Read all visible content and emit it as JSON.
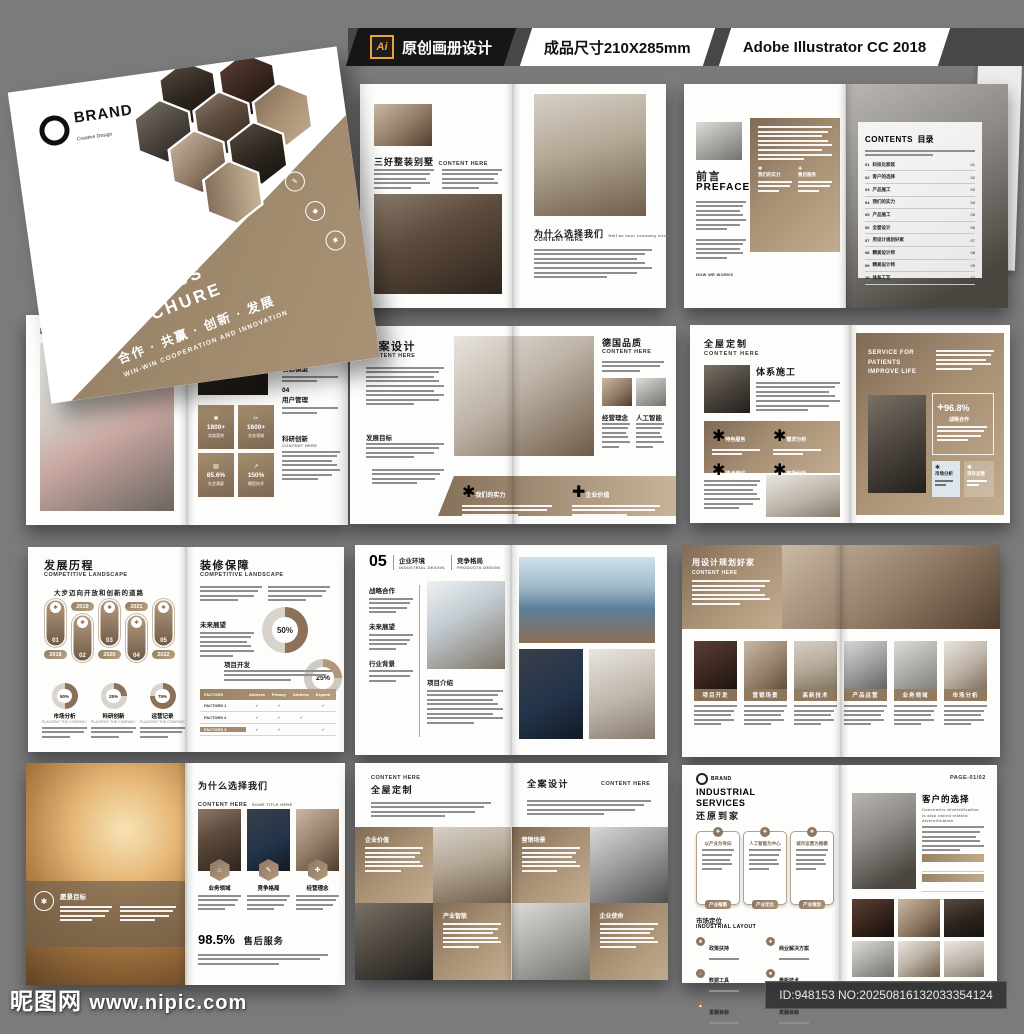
{
  "header": {
    "ai_badge": "Ai",
    "design_label": "原创画册设计",
    "size_label": "成品尺寸210X285mm",
    "software_label": "Adobe Illustrator CC 2018"
  },
  "cover": {
    "brand": "BRAND",
    "brand_sub": "Creative Design",
    "title1": "NEW",
    "title2": "BUSINESS",
    "title3": "BROCHURE",
    "slogan_cn": "合作 · 共赢 · 创新 · 发展",
    "slogan_en": "WIN-WIN COOPERATION AND INNOVATION"
  },
  "spread_a": {
    "left": {
      "title": "三好整装别墅",
      "suffix": "CONTENT HERE"
    },
    "right": {
      "title": "为什么选择我们",
      "subtitle": "CONTENT HERE",
      "note": "Half an hour economy circle"
    }
  },
  "spread_b": {
    "left": {
      "title_cn": "前言",
      "title_en": "PREFACE",
      "col1": "我们的实力",
      "col2": "售后服务",
      "footer": "HOW WE WORKS"
    },
    "right": {
      "title_en": "CONTENTS",
      "title_cn": "目录",
      "items": [
        {
          "no": "01",
          "label": "科技化家装",
          "page": "01"
        },
        {
          "no": "02",
          "label": "客户的选择",
          "page": "02"
        },
        {
          "no": "03",
          "label": "产品施工",
          "page": "03"
        },
        {
          "no": "04",
          "label": "我们的实力",
          "page": "04"
        },
        {
          "no": "05",
          "label": "产品施工",
          "page": "05"
        },
        {
          "no": "06",
          "label": "全屋设计",
          "page": "06"
        },
        {
          "no": "07",
          "label": "用设计规划好家",
          "page": "07"
        },
        {
          "no": "08",
          "label": "精美设计师",
          "page": "08"
        },
        {
          "no": "09",
          "label": "精美设计师",
          "page": "09"
        },
        {
          "no": "10",
          "label": "体系工艺",
          "page": "10"
        }
      ]
    }
  },
  "spread_c": {
    "left": {
      "title": "DEVELOPMENT GOAL"
    },
    "right": {
      "items": [
        {
          "no": "02",
          "label": "服务保障"
        },
        {
          "no": "03",
          "label": "信息模型"
        },
        {
          "no": "04",
          "label": "用户管理"
        }
      ],
      "section": "科研创新",
      "section_sub": "CONTENT HERE",
      "stats": [
        {
          "icon": "✱",
          "value": "1800+",
          "label": "实践案例"
        },
        {
          "icon": "✂",
          "value": "1600+",
          "label": "业务领域"
        },
        {
          "icon": "▤",
          "value": "85.6%",
          "label": "社会满意"
        },
        {
          "icon": "↗",
          "value": "150%",
          "label": "模型技术"
        }
      ]
    }
  },
  "spread_d": {
    "left": {
      "title": "全案设计",
      "subtitle": "CONTENT HERE",
      "section": "发展目标"
    },
    "right": {
      "title": "德国品质",
      "subtitle": "CONTENT HERE",
      "col1": "经营理念",
      "col2": "人工智能"
    },
    "band": {
      "item1": "我们的实力",
      "item2": "企业价值"
    }
  },
  "spread_e": {
    "left": {
      "title": "全屋定制",
      "subtitle": "CONTENT HERE",
      "section": "体系施工",
      "features": [
        "特色服务",
        "需求分析",
        "技术培训",
        "市场分析"
      ]
    },
    "right": {
      "tag1": "SERVICE FOR",
      "tag2": "PATIENTS",
      "tag3": "IMPROVE LIFE",
      "stat_plus": "+",
      "stat_value": "96.8%",
      "stat_label": "战略合作",
      "box1": "市场分析",
      "box2": "项目运营"
    }
  },
  "spread_f": {
    "left": {
      "title": "发展历程",
      "title_en": "COMPETITIVE LANDSCAPE",
      "subtitle": "大步迈向开放和创新的道路",
      "timeline": [
        {
          "no": "01",
          "year": "2018"
        },
        {
          "no": "02",
          "year": "2019"
        },
        {
          "no": "03",
          "year": "2020"
        },
        {
          "no": "04",
          "year": "2021"
        },
        {
          "no": "05",
          "year": "2022"
        }
      ],
      "donuts": [
        {
          "pct": "50%",
          "label": "市场分析",
          "sub": "PLACERAT THE COMPANY."
        },
        {
          "pct": "25%",
          "label": "科研创新",
          "sub": "PLACERAT THE COMPANY."
        },
        {
          "pct": "75%",
          "label": "运营记录",
          "sub": "PLACERAT THE COMPANY."
        }
      ]
    },
    "right": {
      "title": "装修保障",
      "title_en": "COMPETITIVE LANDSCAPE",
      "future": "未来展望",
      "donut1": "50%",
      "donut2": "25%",
      "section": "项目开发",
      "table": {
        "head": [
          "FACTORS",
          "Address",
          "Privacy",
          "Address",
          "Expand"
        ],
        "rows": [
          {
            "label": "FACTORS 1",
            "c": [
              "✓",
              "✓",
              "",
              "✓"
            ]
          },
          {
            "label": "FACTORS 2",
            "c": [
              "✓",
              "✓",
              "✓",
              ""
            ]
          },
          {
            "label": "FACTORS 3",
            "c": [
              "✓",
              "✓",
              "",
              "✓"
            ]
          }
        ]
      }
    }
  },
  "spread_g": {
    "no": "05",
    "col1_cn": "企业环境",
    "col1_en": "INDUSTRIAL DESIGN",
    "col2_cn": "竞争格局",
    "col2_en": "PRODUCTS DESIGN",
    "sections": [
      "战略合作",
      "未来展望",
      "行业背景"
    ],
    "section_bottom": "项目介绍"
  },
  "spread_h": {
    "title": "用设计规划好家",
    "subtitle": "CONTENT HERE",
    "cards": [
      "项目开发",
      "营销场景",
      "高新技术",
      "产品运营",
      "业务领域",
      "市场分析"
    ]
  },
  "spread_i": {
    "left": {
      "overlay": "愿景目标"
    },
    "right": {
      "title": "为什么选择我们",
      "sub1": "CONTENT HERE",
      "sub2": "SOME TITLE HERE",
      "cards": [
        "业务领域",
        "竞争格局",
        "经营理念"
      ],
      "stat": "98.5%",
      "stat_label": "售后服务"
    }
  },
  "spread_j": {
    "left": {
      "eyebrow": "CONTENT HERE",
      "title": "全屋定制",
      "block1": "企业价值",
      "block2": "产业智联"
    },
    "right": {
      "title": "全案设计",
      "eyebrow": "CONTENT HERE",
      "block1": "营销场景",
      "block2": "企业使命"
    }
  },
  "spread_k": {
    "left": {
      "brand": "BRAND",
      "title_en": "INDUSTRIAL SERVICES",
      "title_cn": "还原到家",
      "bubbles": [
        {
          "title": "以产业为导向",
          "tag": "产业楷模"
        },
        {
          "title": "人工智能为中心",
          "tag": "产业定位"
        },
        {
          "title": "城市运营为楷模",
          "tag": "产业规划"
        }
      ],
      "section": "市场定位",
      "section_en": "INDUSTRIAL LAYOUT",
      "bullets": [
        "政策扶持",
        "数据工具",
        "发展目标",
        "商业解决方案",
        "最新技术",
        "发展目标"
      ]
    },
    "right": {
      "page": "PAGE-01/02",
      "title": "客户的选择",
      "subtitle": "Concentric diversification is also called related diversification"
    }
  },
  "watermark": {
    "site": "昵图网",
    "url": "www.nipic.com",
    "id": "ID:948153 NO:20250816132033354124"
  }
}
